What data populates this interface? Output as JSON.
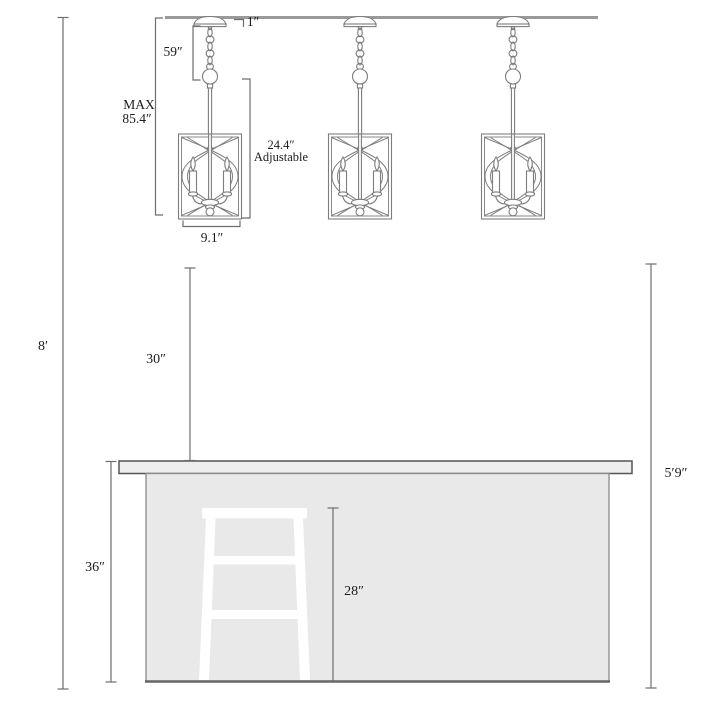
{
  "figure": {
    "type": "pendant-lights-over-kitchen-island dimension diagram",
    "pendant_count": 3
  },
  "labels": {
    "canopy_height": "1″",
    "chain_length": "59″",
    "max_height_line1": "MAX",
    "max_height_line2": "85.4″",
    "adjustable_range_line1": "24.4″",
    "adjustable_range_line2": "Adjustable",
    "fixture_width": "9.1″",
    "ceiling_height": "8′",
    "pendant_to_counter_gap": "30″",
    "counter_height": "36″",
    "stool_height": "28″",
    "floor_to_pendant_clearance": "5′9″"
  },
  "colors": {
    "background": "#ffffff",
    "fixture_line_art": "#7d7d7d",
    "dimension_lines": "#6e6e6e",
    "label_text": "#1c1c1c",
    "ceiling_line": "#9a9a9a",
    "countertop_fill": "#eeeeee",
    "countertop_border": "#555555",
    "island_fill": "#e9e9e9",
    "island_border": "#8a8a8a",
    "stool_fill": "#ffffff"
  }
}
